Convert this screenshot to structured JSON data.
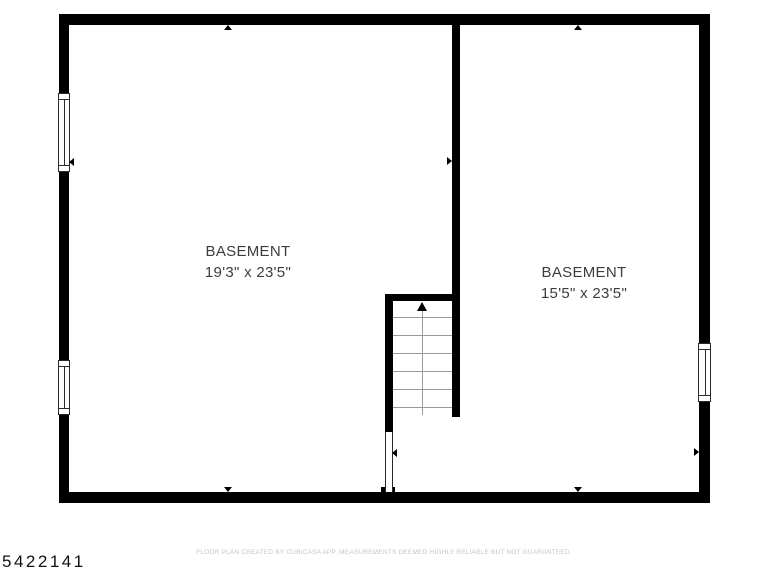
{
  "colors": {
    "wall": "#000000",
    "tread": "#9a9a9a",
    "frame": "#2a2a2a",
    "label": "#3d3d3d",
    "footer": "#c6c5c5",
    "id": "#111111",
    "bg": "#ffffff"
  },
  "plan": {
    "id_label": "5422141",
    "footer": "FLOOR PLAN CREATED BY CUBICASA APP. MEASUREMENTS DEEMED HIGHLY RELIABLE BUT NOT GUARANTEED.",
    "rooms": [
      {
        "name": "BASEMENT",
        "dimensions": "19'3\" x 23'5\""
      },
      {
        "name": "BASEMENT",
        "dimensions": "15'5\" x 23'5\""
      }
    ],
    "stairs": {
      "tread_count": 6,
      "direction_arrow": "up"
    },
    "windows": [
      {
        "wall": "left",
        "position": "upper"
      },
      {
        "wall": "left",
        "position": "lower"
      },
      {
        "wall": "right",
        "position": "middle"
      }
    ],
    "openings": [
      {
        "location": "below-stairs",
        "connects": "BASEMENT to BASEMENT"
      }
    ]
  }
}
